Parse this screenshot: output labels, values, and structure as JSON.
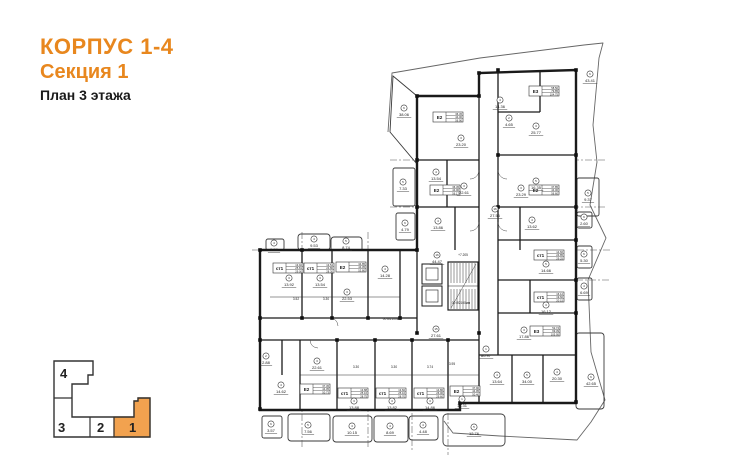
{
  "header": {
    "building": "КОРПУС 1-4",
    "section": "Секция 1",
    "floor": "План 3 этажа"
  },
  "colors": {
    "accent": "#E8871E",
    "keyplan_fill": "#F2A24F",
    "keyplan_active_number": "#B06A10",
    "plan_line": "#333333"
  },
  "keyplan": {
    "sections": [
      {
        "label": "4",
        "active": false
      },
      {
        "label": "3",
        "active": false
      },
      {
        "label": "2",
        "active": false
      },
      {
        "label": "1",
        "active": true
      }
    ]
  },
  "plan": {
    "apartment_tables": [
      {
        "x": 433,
        "y": 112,
        "type": "Е2",
        "rows": [
          "36.45",
          "44.00",
          "56.90"
        ]
      },
      {
        "x": 529,
        "y": 86,
        "type": "Е3",
        "rows": [
          "58.50",
          "79.85",
          "104.75"
        ]
      },
      {
        "x": 430,
        "y": 185,
        "type": "Е2",
        "rows": [
          "36.45",
          "44.00",
          "56.17"
        ]
      },
      {
        "x": 529,
        "y": 185,
        "type": "Е2",
        "rows": [
          "37.85",
          "44.00",
          "56.60"
        ]
      },
      {
        "x": 273,
        "y": 263,
        "type": "ст1",
        "rows": [
          "13.92",
          "25.81",
          "29.00"
        ]
      },
      {
        "x": 304,
        "y": 263,
        "type": "ст1",
        "rows": [
          "13.54",
          "24.80",
          "28.30"
        ]
      },
      {
        "x": 336,
        "y": 262,
        "type": "Е2",
        "rows": [
          "34.85",
          "44.05",
          "53.80"
        ]
      },
      {
        "x": 534,
        "y": 250,
        "type": "ст1",
        "rows": [
          "14.66",
          "24.85",
          "29.25"
        ]
      },
      {
        "x": 534,
        "y": 292,
        "type": "ст1",
        "rows": [
          "16.12",
          "19.60",
          "20.15"
        ]
      },
      {
        "x": 530,
        "y": 326,
        "type": "Е3",
        "rows": [
          "52.74",
          "69.39",
          "105.95"
        ]
      },
      {
        "x": 300,
        "y": 384,
        "type": "Е2",
        "rows": [
          "37.45",
          "44.05",
          "50.73"
        ]
      },
      {
        "x": 338,
        "y": 388,
        "type": "ст1",
        "rows": [
          "13.88",
          "25.16",
          "28.75"
        ]
      },
      {
        "x": 376,
        "y": 388,
        "type": "ст1",
        "rows": [
          "13.82",
          "25.10",
          "28.70"
        ]
      },
      {
        "x": 414,
        "y": 388,
        "type": "ст1",
        "rows": [
          "14.86",
          "26.00",
          "29.60"
        ]
      },
      {
        "x": 450,
        "y": 386,
        "type": "Е2",
        "rows": [
          "37.90",
          "44.95",
          "50.40"
        ]
      }
    ],
    "rooms": [
      {
        "x": 461,
        "y": 138,
        "n": "3",
        "a": "23.20"
      },
      {
        "x": 500,
        "y": 100,
        "n": "4",
        "a": "14.36"
      },
      {
        "x": 536,
        "y": 126,
        "n": "3",
        "a": "25.77"
      },
      {
        "x": 436,
        "y": 172,
        "n": "4",
        "a": "13.54"
      },
      {
        "x": 536,
        "y": 181,
        "n": "5",
        "a": "16.35"
      },
      {
        "x": 464,
        "y": 186,
        "n": "3",
        "a": "22.61"
      },
      {
        "x": 521,
        "y": 188,
        "n": "3",
        "a": "23.29"
      },
      {
        "x": 438,
        "y": 221,
        "n": "4",
        "a": "13.86"
      },
      {
        "x": 532,
        "y": 220,
        "n": "4",
        "a": "13.62"
      },
      {
        "x": 289,
        "y": 278,
        "n": "3",
        "a": "13.92"
      },
      {
        "x": 320,
        "y": 278,
        "n": "3",
        "a": "13.54"
      },
      {
        "x": 347,
        "y": 292,
        "n": "3",
        "a": "22.53"
      },
      {
        "x": 385,
        "y": 269,
        "n": "4",
        "a": "14.28"
      },
      {
        "x": 546,
        "y": 264,
        "n": "5",
        "a": "14.66"
      },
      {
        "x": 546,
        "y": 305,
        "n": "3",
        "a": "16.12"
      },
      {
        "x": 524,
        "y": 330,
        "n": "3",
        "a": "17.86"
      },
      {
        "x": 281,
        "y": 385,
        "n": "4",
        "a": "14.62"
      },
      {
        "x": 317,
        "y": 361,
        "n": "3",
        "a": "22.61"
      },
      {
        "x": 354,
        "y": 401,
        "n": "3",
        "a": "13.88"
      },
      {
        "x": 392,
        "y": 401,
        "n": "3",
        "a": "13.82"
      },
      {
        "x": 430,
        "y": 401,
        "n": "3",
        "a": "14.86"
      },
      {
        "x": 462,
        "y": 399,
        "n": "1",
        "a": "14.31"
      },
      {
        "x": 497,
        "y": 375,
        "n": "4",
        "a": "13.64"
      },
      {
        "x": 527,
        "y": 375,
        "n": "5",
        "a": "34.00"
      },
      {
        "x": 557,
        "y": 372,
        "n": "4",
        "a": "20.30"
      },
      {
        "x": 266,
        "y": 356,
        "n": "2",
        "a": "2.88"
      },
      {
        "x": 509,
        "y": 118,
        "n": "2",
        "a": "4.65"
      },
      {
        "x": 495,
        "y": 209,
        "n": "16",
        "a": "27.56"
      },
      {
        "x": 437,
        "y": 255,
        "n": "16",
        "a": "44.47"
      },
      {
        "x": 436,
        "y": 329,
        "n": "15",
        "a": "27.61"
      },
      {
        "x": 486,
        "y": 349,
        "n": "1",
        "a": "80.97"
      }
    ],
    "terraces": [
      {
        "x": 404,
        "y": 108,
        "n": "6",
        "a": "38.06"
      },
      {
        "x": 590,
        "y": 74,
        "n": "6",
        "a": "43.41"
      },
      {
        "x": 403,
        "y": 182,
        "n": "5",
        "a": "7.33"
      },
      {
        "x": 405,
        "y": 223,
        "n": "6",
        "a": "4.79"
      },
      {
        "x": 588,
        "y": 193,
        "n": "5",
        "a": "9.37"
      },
      {
        "x": 584,
        "y": 217,
        "n": "6",
        "a": "2.60"
      },
      {
        "x": 584,
        "y": 254,
        "n": "6",
        "a": "5.30"
      },
      {
        "x": 584,
        "y": 286,
        "n": "4",
        "a": "6.69"
      },
      {
        "x": 591,
        "y": 377,
        "n": "6",
        "a": "42.65"
      },
      {
        "x": 274,
        "y": 243,
        "n": "4",
        "a": "3.28"
      },
      {
        "x": 314,
        "y": 239,
        "n": "4",
        "a": "9.53"
      },
      {
        "x": 346,
        "y": 241,
        "n": "5",
        "a": "8.74"
      },
      {
        "x": 271,
        "y": 424,
        "n": "6",
        "a": "3.57"
      },
      {
        "x": 308,
        "y": 425,
        "n": "5",
        "a": "7.56"
      },
      {
        "x": 352,
        "y": 426,
        "n": "4",
        "a": "10.15"
      },
      {
        "x": 390,
        "y": 426,
        "n": "4",
        "a": "8.69"
      },
      {
        "x": 423,
        "y": 425,
        "n": "4",
        "a": "4.48"
      },
      {
        "x": 474,
        "y": 427,
        "n": "5",
        "a": "12.76"
      }
    ],
    "notes": [
      {
        "x": 461,
        "y": 304,
        "t": "00 Ø2100мм"
      },
      {
        "x": 392,
        "y": 320,
        "t": "00 Ø2100мм"
      },
      {
        "x": 463,
        "y": 256,
        "t": "+7.205"
      },
      {
        "x": 356,
        "y": 368,
        "t": "3.30"
      },
      {
        "x": 394,
        "y": 368,
        "t": "3.30"
      },
      {
        "x": 430,
        "y": 368,
        "t": "3.74"
      },
      {
        "x": 452,
        "y": 365,
        "t": "3.95"
      },
      {
        "x": 296,
        "y": 300,
        "t": "3.52"
      },
      {
        "x": 326,
        "y": 300,
        "t": "3.30"
      }
    ]
  }
}
